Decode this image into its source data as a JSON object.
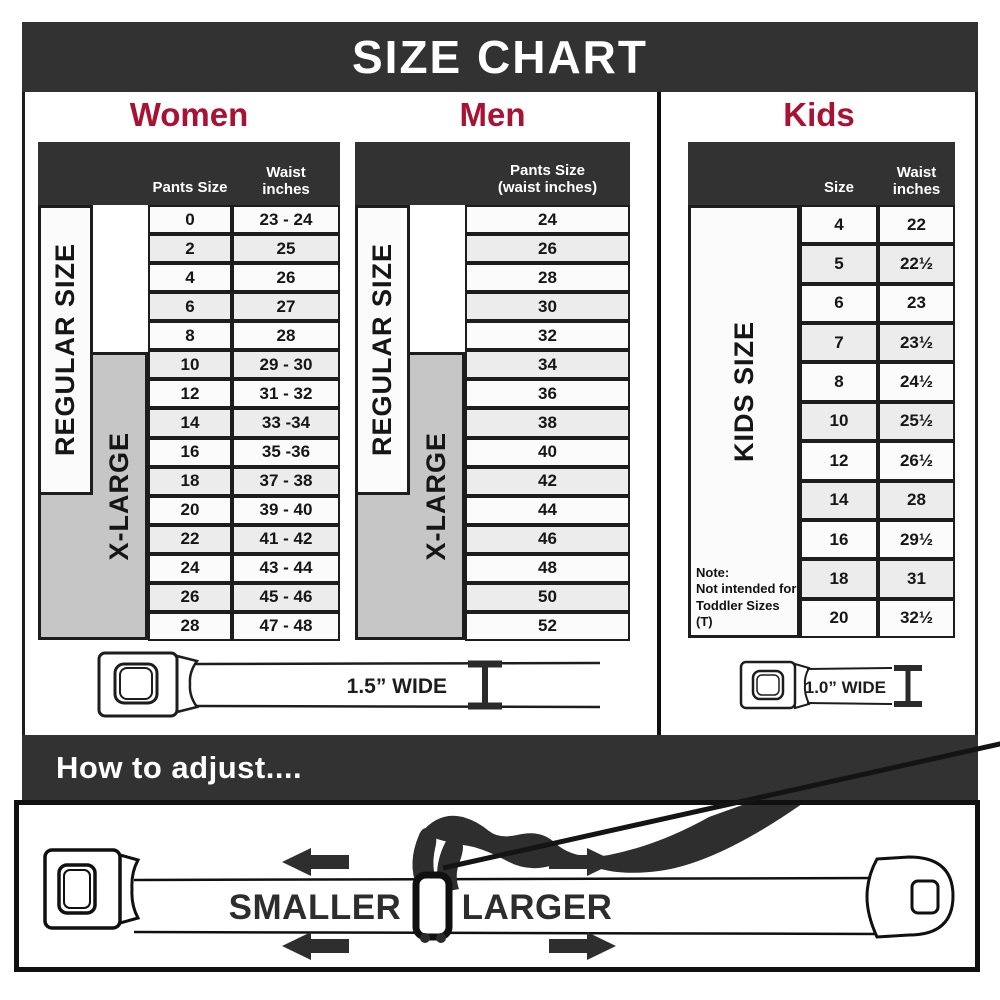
{
  "title": "SIZE CHART",
  "colors": {
    "accent": "#a81233",
    "header_dark": "#333233",
    "xlarge_gray": "#c6c6c6",
    "row_alt": "#ececec"
  },
  "women": {
    "title": "Women",
    "header": {
      "pants": "Pants Size",
      "waist1": "Waist",
      "waist2": "inches"
    },
    "regular_label": "REGULAR SIZE",
    "xlarge_label": "X-LARGE",
    "rows": [
      {
        "size": "0",
        "waist": "23 - 24"
      },
      {
        "size": "2",
        "waist": "25"
      },
      {
        "size": "4",
        "waist": "26"
      },
      {
        "size": "6",
        "waist": "27"
      },
      {
        "size": "8",
        "waist": "28"
      },
      {
        "size": "10",
        "waist": "29 - 30"
      },
      {
        "size": "12",
        "waist": "31 - 32"
      },
      {
        "size": "14",
        "waist": "33 -34"
      },
      {
        "size": "16",
        "waist": "35 -36"
      },
      {
        "size": "18",
        "waist": "37 - 38"
      },
      {
        "size": "20",
        "waist": "39 - 40"
      },
      {
        "size": "22",
        "waist": "41 - 42"
      },
      {
        "size": "24",
        "waist": "43 - 44"
      },
      {
        "size": "26",
        "waist": "45 - 46"
      },
      {
        "size": "28",
        "waist": "47 - 48"
      }
    ]
  },
  "men": {
    "title": "Men",
    "header": {
      "line1": "Pants Size",
      "line2": "(waist inches)"
    },
    "regular_label": "REGULAR SIZE",
    "xlarge_label": "X-LARGE",
    "rows": [
      "24",
      "26",
      "28",
      "30",
      "32",
      "34",
      "36",
      "38",
      "40",
      "42",
      "44",
      "46",
      "48",
      "50",
      "52"
    ]
  },
  "kids": {
    "title": "Kids",
    "header": {
      "size": "Size",
      "waist1": "Waist",
      "waist2": "inches"
    },
    "side_label": "KIDS SIZE",
    "note_line1": "Note:",
    "note_line2": "Not intended for",
    "note_line3": "Toddler Sizes (T)",
    "rows": [
      {
        "size": "4",
        "waist": "22"
      },
      {
        "size": "5",
        "waist": "22½"
      },
      {
        "size": "6",
        "waist": "23"
      },
      {
        "size": "7",
        "waist": "23½"
      },
      {
        "size": "8",
        "waist": "24½"
      },
      {
        "size": "10",
        "waist": "25½"
      },
      {
        "size": "12",
        "waist": "26½"
      },
      {
        "size": "14",
        "waist": "28"
      },
      {
        "size": "16",
        "waist": "29½"
      },
      {
        "size": "18",
        "waist": "31"
      },
      {
        "size": "20",
        "waist": "32½"
      }
    ]
  },
  "belts": {
    "adult_label": "1.5” WIDE",
    "kids_label": "1.0” WIDE"
  },
  "adjust": {
    "title": "How to adjust....",
    "smaller_label": "SMALLER",
    "larger_label": "LARGER"
  }
}
